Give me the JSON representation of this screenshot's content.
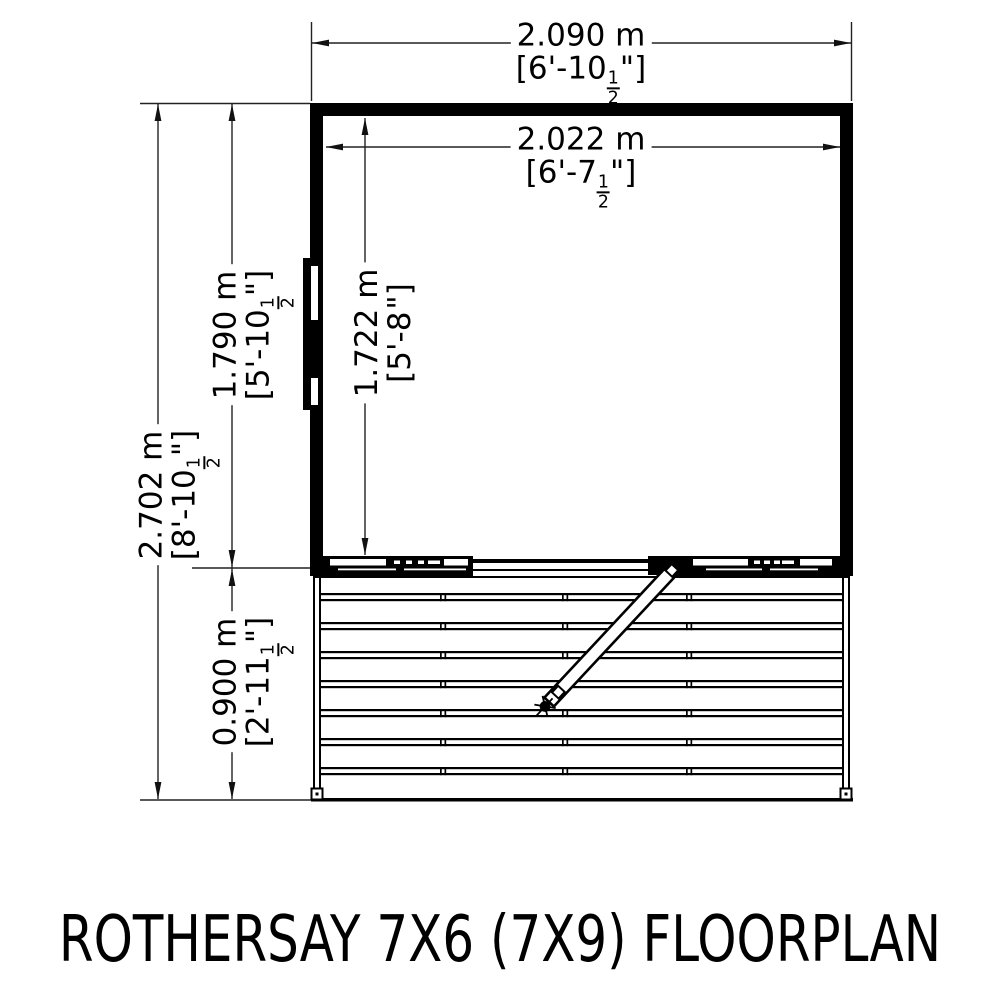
{
  "title": "ROTHERSAY 7X6 (7X9) FLOORPLAN",
  "colors": {
    "line": "#000000",
    "dimension_line": "#222222",
    "background": "#ffffff"
  },
  "dimensions": {
    "outer_width": {
      "metric": "2.090 m",
      "imperial_pre": "[6'-10",
      "frac_num": "1",
      "frac_den": "2",
      "imperial_post": "\"]"
    },
    "inner_width": {
      "metric": "2.022 m",
      "imperial_pre": "[6'-7",
      "frac_num": "1",
      "frac_den": "2",
      "imperial_post": "\"]"
    },
    "total_depth": {
      "metric": "2.702 m",
      "imperial_pre": "[8'-10",
      "frac_num": "1",
      "frac_den": "2",
      "imperial_post": "\"]"
    },
    "shed_depth": {
      "metric": "1.790 m",
      "imperial_pre": "[5'-10",
      "frac_num": "1",
      "frac_den": "2",
      "imperial_post": "\"]"
    },
    "inner_depth": {
      "metric": "1.722 m",
      "imperial_pre": "[5'-8",
      "frac_num": "",
      "frac_den": "",
      "imperial_post": "\"]"
    },
    "veranda_depth": {
      "metric": "0.900 m",
      "imperial_pre": "[2'-11",
      "frac_num": "1",
      "frac_den": "2",
      "imperial_post": "\"]"
    }
  }
}
